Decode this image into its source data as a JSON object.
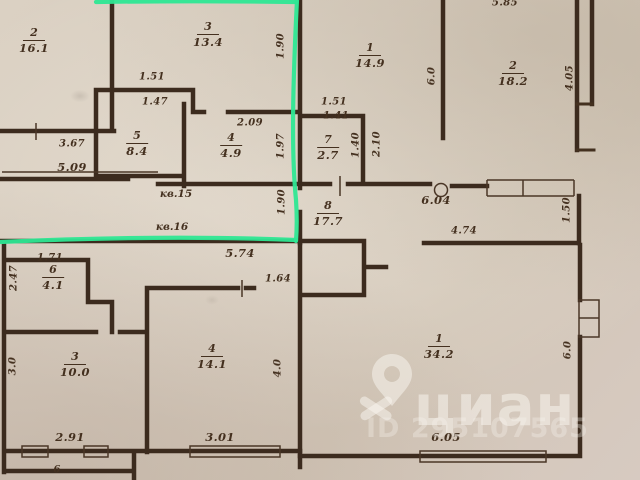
{
  "canvas": {
    "width": 640,
    "height": 480
  },
  "colors": {
    "paper": "#d7ccbf",
    "wall": "#3c2b1e",
    "ink": "#44301f",
    "highlight_green": "#2ee794",
    "watermark_white": "#faf6f0"
  },
  "rooms": [
    {
      "key": "2-top-left",
      "number": "2",
      "area": "16.1",
      "x": 34,
      "y": 27
    },
    {
      "key": "3-top",
      "number": "3",
      "area": "13.4",
      "x": 208,
      "y": 21
    },
    {
      "key": "5-closet",
      "number": "5",
      "area": "8.4",
      "x": 137,
      "y": 130
    },
    {
      "key": "4-top",
      "number": "4",
      "area": "4.9",
      "x": 231,
      "y": 132
    },
    {
      "key": "1-top",
      "number": "1",
      "area": "14.9",
      "x": 370,
      "y": 42
    },
    {
      "key": "2-top-right",
      "number": "2",
      "area": "18.2",
      "x": 513,
      "y": 60
    },
    {
      "key": "7-closet",
      "number": "7",
      "area": "2.7",
      "x": 328,
      "y": 134
    },
    {
      "key": "8-hall",
      "number": "8",
      "area": "17.7",
      "x": 328,
      "y": 200
    },
    {
      "key": "6-small",
      "number": "6",
      "area": "4.1",
      "x": 53,
      "y": 264
    },
    {
      "key": "3-bottom",
      "number": "3",
      "area": "10.0",
      "x": 75,
      "y": 351
    },
    {
      "key": "4-bottom",
      "number": "4",
      "area": "14.1",
      "x": 212,
      "y": 343
    },
    {
      "key": "1-bottom",
      "number": "1",
      "area": "34.2",
      "x": 439,
      "y": 333
    }
  ],
  "dimensions": [
    {
      "text": "3.67",
      "x": 72,
      "y": 144
    },
    {
      "text": "5.09",
      "x": 72,
      "y": 167,
      "size": "lg"
    },
    {
      "text": "1.51",
      "x": 152,
      "y": 77
    },
    {
      "text": "1.47",
      "x": 155,
      "y": 102
    },
    {
      "text": "2.09",
      "x": 250,
      "y": 123
    },
    {
      "text": "1.97",
      "x": 281,
      "y": 146,
      "v": true
    },
    {
      "text": "1.90",
      "x": 281,
      "y": 46,
      "v": true
    },
    {
      "text": "1.90",
      "x": 282,
      "y": 202,
      "v": true
    },
    {
      "text": "5.74",
      "x": 240,
      "y": 253,
      "size": "lg"
    },
    {
      "text": "1.51",
      "x": 334,
      "y": 102
    },
    {
      "text": "1.41",
      "x": 336,
      "y": 116
    },
    {
      "text": "1.40",
      "x": 356,
      "y": 145,
      "v": true
    },
    {
      "text": "2.10",
      "x": 377,
      "y": 144,
      "v": true
    },
    {
      "text": "6.0",
      "x": 432,
      "y": 76,
      "v": true
    },
    {
      "text": "4.05",
      "x": 570,
      "y": 78,
      "v": true
    },
    {
      "text": "5.85",
      "x": 505,
      "y": 3
    },
    {
      "text": "6.04",
      "x": 436,
      "y": 200,
      "size": "lg"
    },
    {
      "text": "4.74",
      "x": 464,
      "y": 231
    },
    {
      "text": "1.50",
      "x": 567,
      "y": 210,
      "v": true
    },
    {
      "text": "1.71",
      "x": 50,
      "y": 258
    },
    {
      "text": "2.47",
      "x": 14,
      "y": 278,
      "v": true
    },
    {
      "text": "3.0",
      "x": 13,
      "y": 366,
      "v": true
    },
    {
      "text": "2.91",
      "x": 70,
      "y": 437,
      "size": "lg"
    },
    {
      "text": "1.64",
      "x": 278,
      "y": 279
    },
    {
      "text": "3.01",
      "x": 220,
      "y": 437,
      "size": "lg"
    },
    {
      "text": "4.0",
      "x": 278,
      "y": 368,
      "v": true
    },
    {
      "text": "6.05",
      "x": 446,
      "y": 437,
      "size": "lg"
    },
    {
      "text": "6.0",
      "x": 568,
      "y": 350,
      "v": true
    },
    {
      "text": "6",
      "x": 57,
      "y": 470
    }
  ],
  "unit_labels": [
    {
      "text": "кв.15",
      "x": 176,
      "y": 194
    },
    {
      "text": "кв.16",
      "x": 172,
      "y": 227
    }
  ],
  "watermark": {
    "brand": "циан",
    "id_label": "ID 295107565",
    "pin_icon": "map-pin-icon"
  }
}
